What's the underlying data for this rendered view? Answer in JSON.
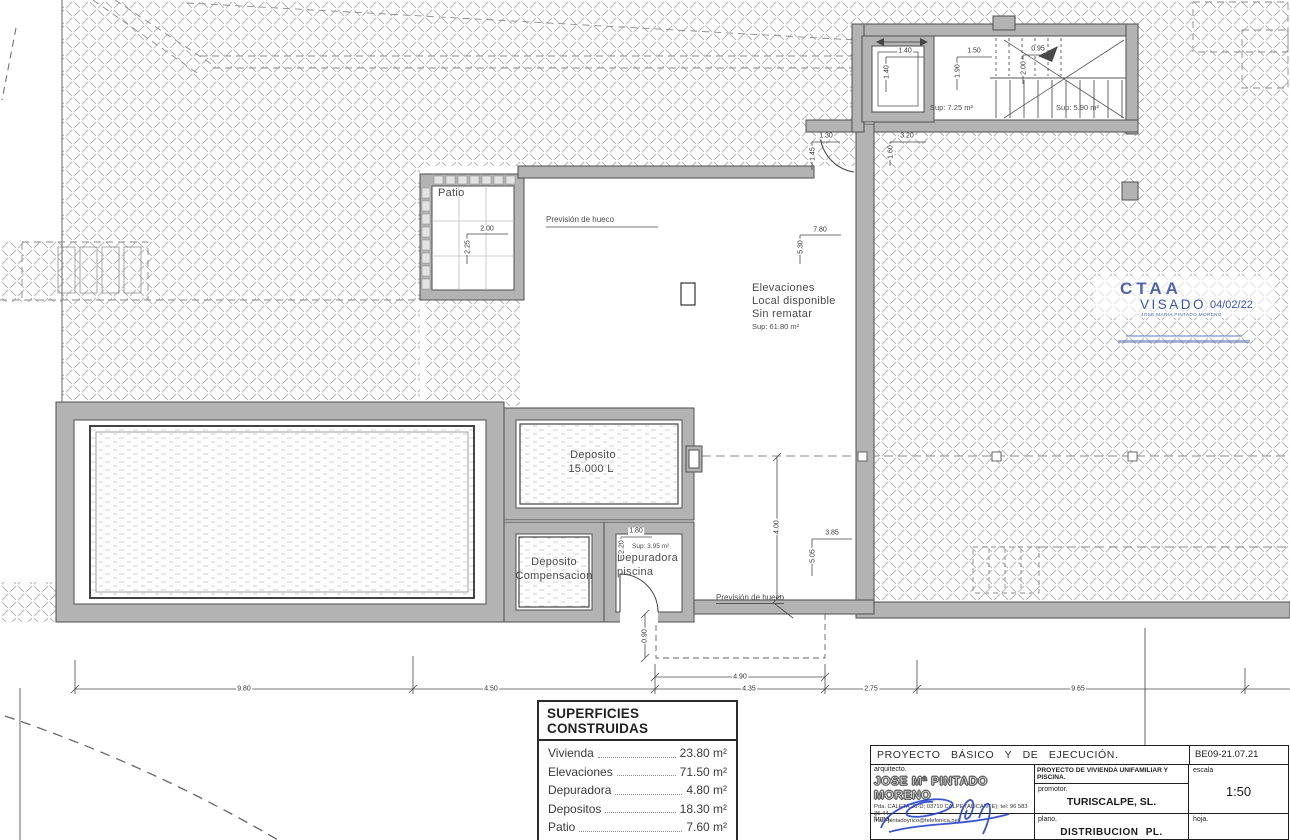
{
  "plan": {
    "labels": {
      "patio": "Patio",
      "prevision_hueco_top": "Previsión de hueco",
      "prevision_hueco_bottom": "Previsión de hueco",
      "local_line1": "Elevaciones",
      "local_line2": "Local disponible",
      "local_line3": "Sin rematar",
      "local_sup": "Sup: 61.80 m²",
      "deposito_line1": "Deposito",
      "deposito_line2": "15.000 L",
      "comp_line1": "Deposito",
      "comp_line2": "Compensacion",
      "depuradora_line1": "Depuradora",
      "depuradora_line2": "piscina",
      "depuradora_sup": "Sup: 3.95 m²",
      "sup_ascensor": "Sup: 7.25 m²",
      "sup_escalera": "Sup: 5.90 m²"
    },
    "dims": {
      "bottom_1": "9.80",
      "bottom_2": "4.50",
      "bottom_3": "4.35",
      "bottom_4": "2.75",
      "bottom_5": "9.65",
      "hueco_w": "4.90",
      "hueco_h": "0.90",
      "room_h": "4.00",
      "top_w": "7.80",
      "top_h": "5.30",
      "patio_w": "2.00",
      "patio_h": "2.25",
      "pilar_w": "3.85",
      "pilar_h": "5.05",
      "dep_w": "1.80",
      "dep_h": "2.20",
      "lift_w": "1.40",
      "lift_h": "1.40",
      "hall1_w": "1.50",
      "hall1_h": "1.90",
      "hall2_w": "0.95",
      "hall2_h": "2.00",
      "door_w": "1.30",
      "door_h": "1.45",
      "pas_w": "3.20",
      "pas_h": "1.60"
    }
  },
  "stamp": {
    "org": "CTAA",
    "visado": "VISADO",
    "date": "04/02/22",
    "holder": "JOSE MARIA PINTADO MORENO",
    "accent_color": "#3b55a8"
  },
  "table": {
    "title": "SUPERFICIES CONSTRUIDAS",
    "rows": [
      {
        "label": "Vivienda",
        "value": "23.80 m²"
      },
      {
        "label": "Elevaciones",
        "value": "71.50 m²"
      },
      {
        "label": "Depuradora",
        "value": "4.80 m²"
      },
      {
        "label": "Depositos",
        "value": "18.30 m²"
      },
      {
        "label": "Patio",
        "value": "7.60 m²"
      },
      {
        "label": "Voladizo",
        "value": "4.40 m²"
      }
    ],
    "total_label": "Total",
    "total_value": "122.90 m²"
  },
  "titleblock": {
    "project": "PROYECTO BÁSICO Y DE EJECUCIÓN.",
    "code": "BE09-21.07.21",
    "architect_label": "arquitecto.",
    "architect": "JOSE Mª PINTADO MORENO",
    "address": "Pda. CALETA 25-D; 03710 CALPE (ALICANTE); tel: 96 583 35 44.",
    "email": "mail. pintadoyrico@telefonica.net",
    "project_title": "PROYECTO DE VIVIENDA UNIFAMILIAR Y PISCINA.",
    "promoter_label": "promotor.",
    "promoter": "TURISCALPE, SL.",
    "scale_label": "escala",
    "scale": "1:50",
    "signature_label": "firma.",
    "plan_label": "plano.",
    "plan_name": "DISTRIBUCION PL. SEMISOTANO",
    "sheet_label": "hoja."
  }
}
